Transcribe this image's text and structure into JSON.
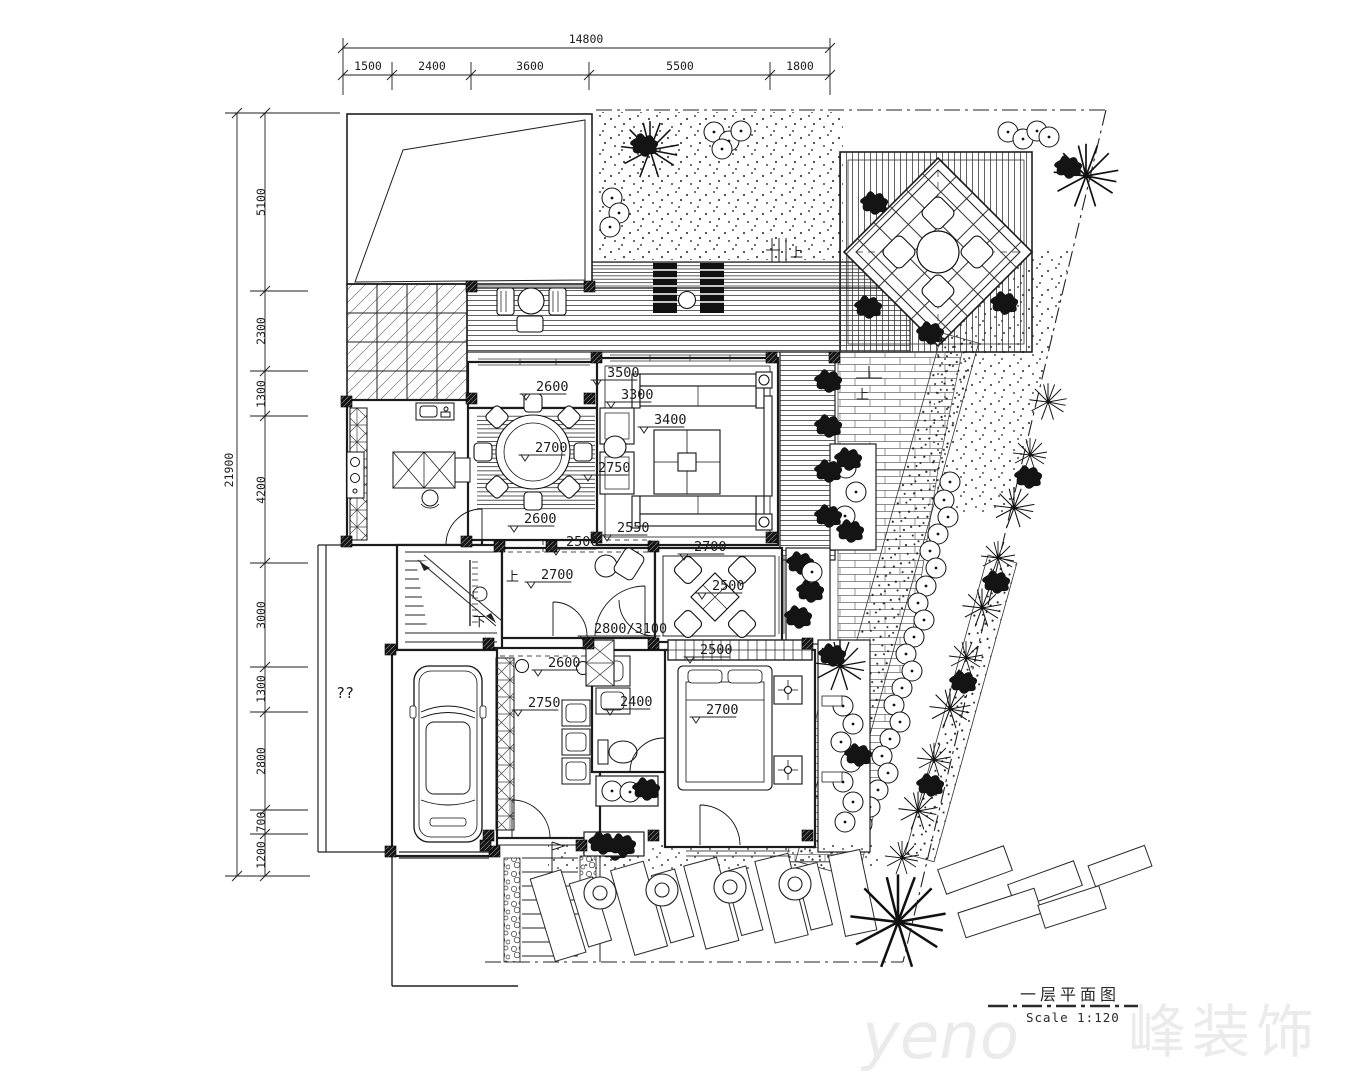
{
  "drawing": {
    "title": "一层平面图",
    "scale_label": "Scale 1:120"
  },
  "watermark": {
    "latin": "yeno",
    "cjk": "峰装饰"
  },
  "markers": {
    "up": "上",
    "down": "下",
    "unknown": "??"
  },
  "dim_top": {
    "total": "14800",
    "seg": [
      "1500",
      "2400",
      "3600",
      "5500",
      "1800"
    ]
  },
  "dim_left": {
    "total": "21900",
    "seg": [
      "5100",
      "2300",
      "1300",
      "4200",
      "3000",
      "1300",
      "2800",
      "700",
      "1200"
    ]
  },
  "room_dims": {
    "porch": "2600",
    "living_w": "3500",
    "living_top": "3300",
    "living": "3400",
    "dining": "2700",
    "sofa_side": "2750",
    "pantry": "2600",
    "pantry_dash": "2500",
    "living_s": "2550",
    "hall": "2700",
    "corridor": "2700",
    "tea": "2500",
    "entry": "2800/3100",
    "closet": "2500",
    "utility_n": "2600",
    "utility": "2750",
    "bath": "2400",
    "bedroom": "2700"
  }
}
